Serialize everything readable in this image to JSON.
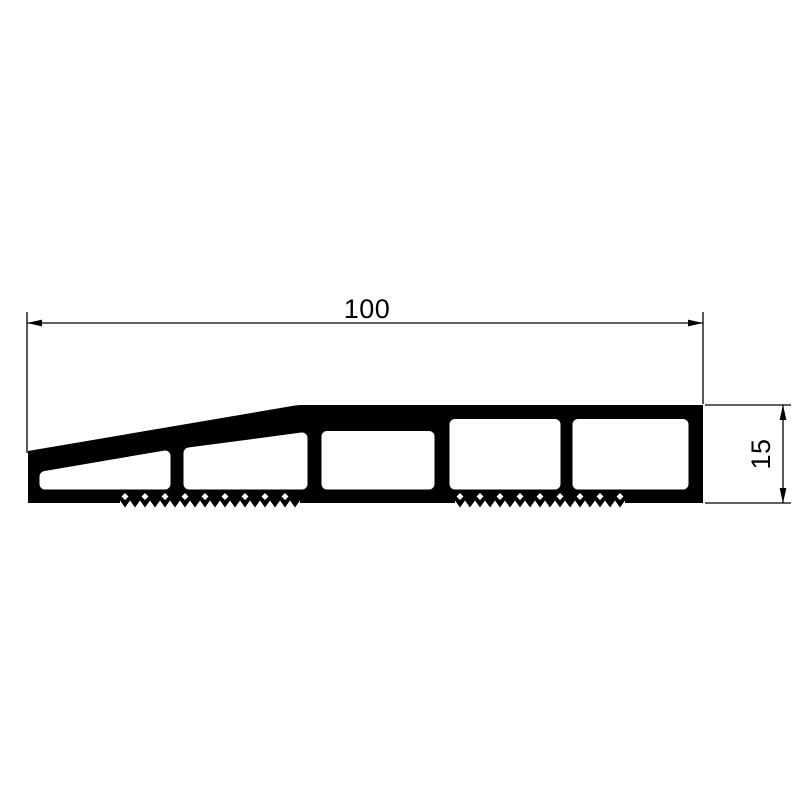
{
  "drawing": {
    "kind": "technical-cross-section-profile",
    "dimensions": {
      "width": {
        "label": "100"
      },
      "height": {
        "label": "15"
      }
    },
    "colors": {
      "ink": "#000000",
      "paper": "#ffffff"
    }
  }
}
